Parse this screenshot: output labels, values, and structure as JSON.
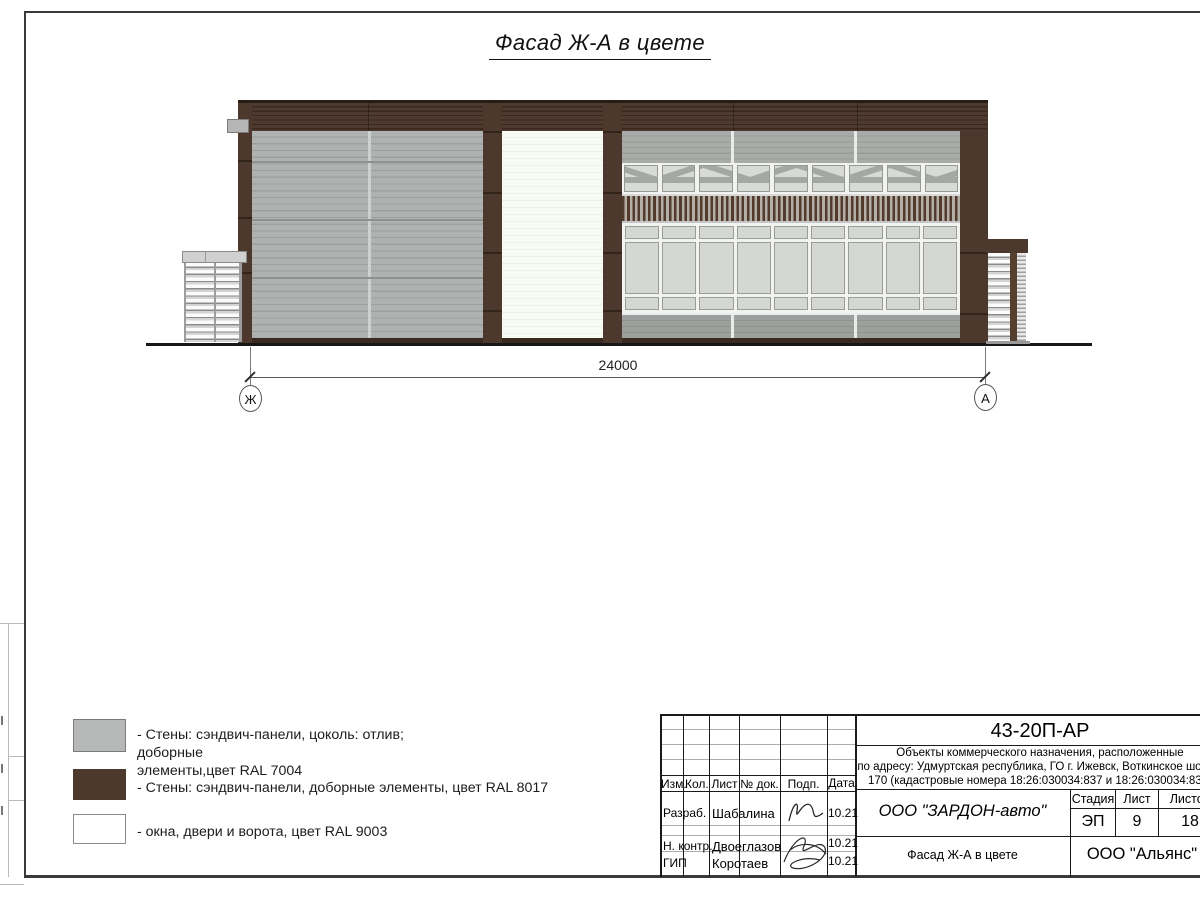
{
  "sheet": {
    "title": "Фасад Ж-А в цвете"
  },
  "drawing": {
    "dimension_label": "24000",
    "axis_left": "Ж",
    "axis_right": "А"
  },
  "legend": {
    "items": [
      {
        "color": "#b6b8b7",
        "line1": "- Стены: сэндвич-панели, цоколь: отлив; доборные",
        "line2": "элементы,цвет RAL 7004"
      },
      {
        "color": "#4c382d",
        "line1": "- Стены: сэндвич-панели, доборные элементы, цвет RAL 8017",
        "line2": ""
      },
      {
        "color": "#ffffff",
        "line1": "- окна, двери и ворота, цвет RAL 9003",
        "line2": ""
      }
    ]
  },
  "titleblock": {
    "doc_code": "43-20П-АР",
    "description_lines": [
      "Объекты коммерческого назначения, расположенные",
      "по адресу: Удмуртская республика, ГО г. Ижевск, Воткинское шоссе,",
      "170 (кадастровые номера 18:26:030034:837 и 18:26:030034:838)"
    ],
    "col_izm": "Изм.",
    "col_kol": "Кол.",
    "col_list": "Лист",
    "col_doc": "№ док.",
    "col_podp": "Подп.",
    "col_data": "Дата",
    "row1_role": "Разраб.",
    "row1_name": "Шабалина",
    "row1_date": "10.21",
    "row2_role": "Н. контр.",
    "row2_name": "Двоеглазов",
    "row2_date": "10.21",
    "row3_role": "ГИП",
    "row3_name": "Коротаев",
    "row3_date": "10.21",
    "company": "ООО \"ЗАРДОН-авто\"",
    "stage_label": "Стадия",
    "sheet_label": "Лист",
    "sheets_label": "Листов",
    "stage_value": "ЭП",
    "sheet_value": "9",
    "sheets_value": "18",
    "drawing_name": "Фасад Ж-А в цвете",
    "org_name": "ООО \"Альянс\""
  }
}
